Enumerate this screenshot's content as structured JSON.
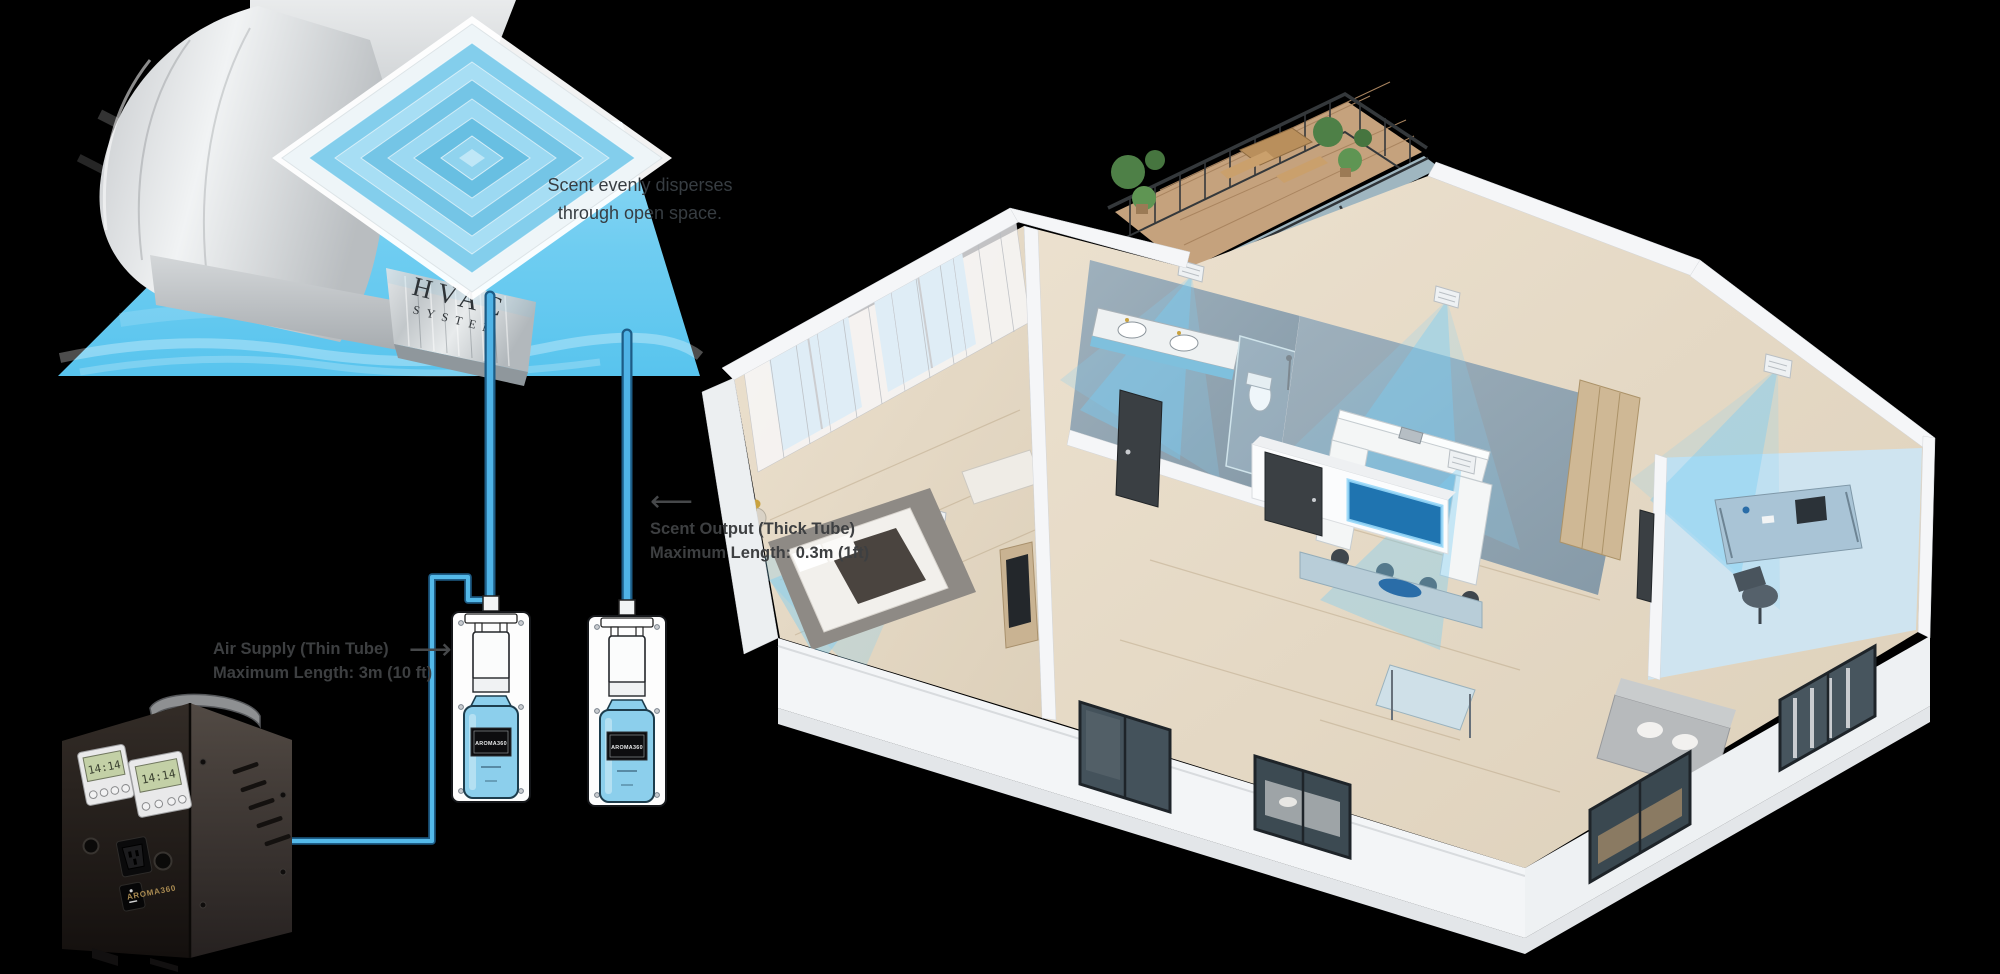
{
  "scene": {
    "background": "#000000",
    "accent_blue": "#5ec9ef",
    "tube_blue": "#54b9e9",
    "tube_outline": "#1d5c86",
    "duct_silver": "#d7dadc",
    "machine_black": "#201a17",
    "bottle_blue": "#8ccfec",
    "gold": "#ab8c52"
  },
  "hvac_unit": {
    "label_line1": "HVAC",
    "label_line2": "SYSTEM"
  },
  "annotations": {
    "dispersion_line1": "Scent evenly disperses",
    "dispersion_line2": "through open space.",
    "scent_output_arrow": "⟵",
    "scent_output_line1": "Scent Output (Thick Tube)",
    "scent_output_line2": "Maximum Length: 0.3m (1ft)",
    "air_supply_line1": "Air Supply (Thin Tube)",
    "air_supply_arrow": "⟶",
    "air_supply_line2": "Maximum Length: 3m (10 ft)"
  },
  "machine": {
    "brand": "AROMA360",
    "display_left": "14:14",
    "display_right": "14:14"
  },
  "diffusers": {
    "left_label": "AROMA360",
    "right_label": "AROMA360"
  }
}
